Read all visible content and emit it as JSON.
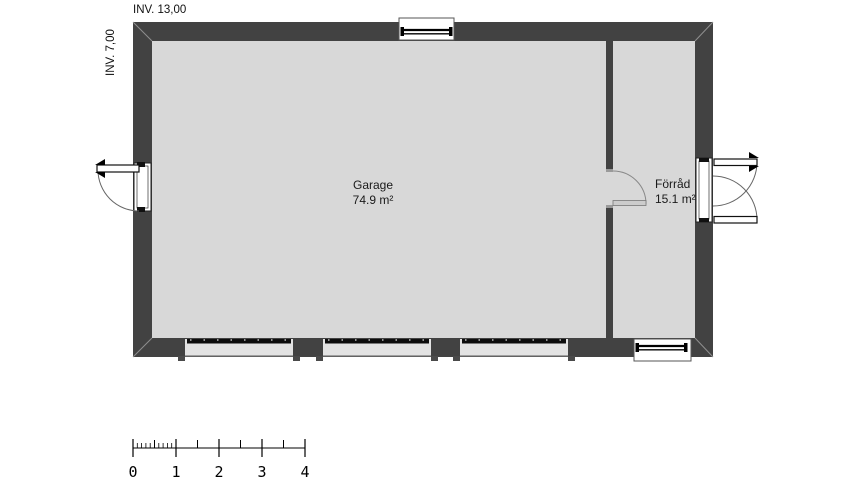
{
  "plan": {
    "title": "garage-floor-plan",
    "dimensions": {
      "width_label": "INV. 13,00",
      "height_label": "INV. 7,00"
    },
    "rooms": [
      {
        "name": "Garage",
        "area": "74.9 m²"
      },
      {
        "name": "Förråd",
        "area": "15.1 m²"
      }
    ],
    "scale_bar": {
      "unit_labels": [
        "0",
        "1",
        "2",
        "3",
        "4"
      ]
    },
    "features": {
      "garage_door_count": 3,
      "windows": [
        "top-window",
        "bottom-window"
      ],
      "doors": [
        "left-entry-door",
        "right-double-door",
        "interior-door"
      ]
    },
    "colors": {
      "wall": "#424242",
      "floor": "#d8d8d8",
      "background": "#ffffff",
      "line": "#000000",
      "opening_fill": "#e3e3e3"
    }
  }
}
